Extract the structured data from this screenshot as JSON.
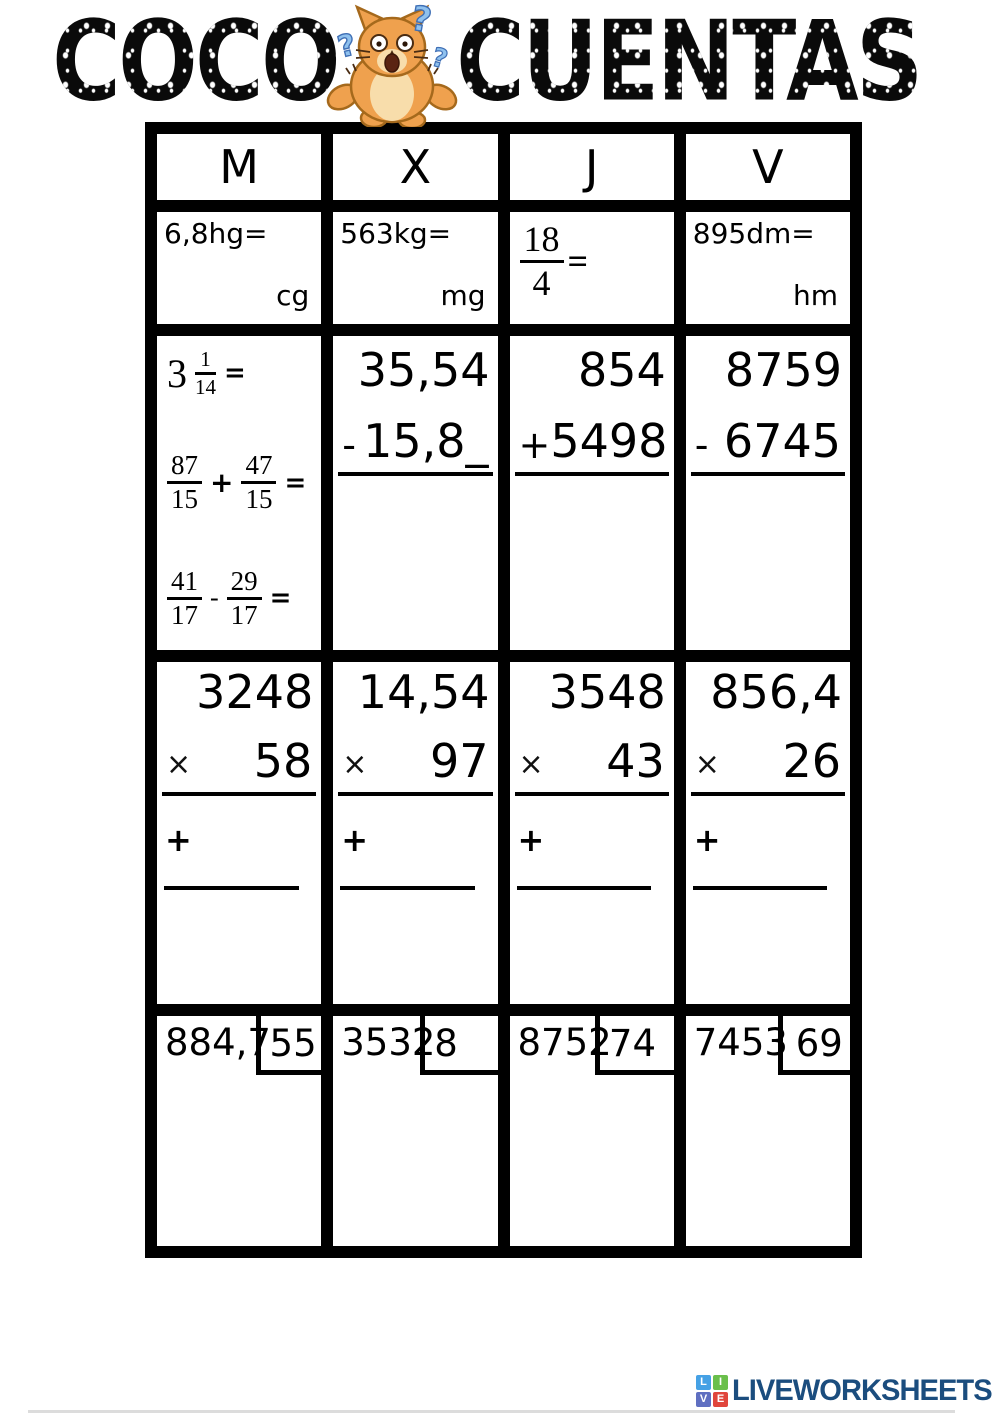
{
  "title": {
    "left": "COCO",
    "right": "CUENTAS"
  },
  "table": {
    "headers": [
      "M",
      "X",
      "J",
      "V"
    ],
    "conversions": [
      {
        "expr": "6,8hg=",
        "unit": "cg"
      },
      {
        "expr": "563kg=",
        "unit": "mg"
      },
      {
        "num": "18",
        "den": "4",
        "eq": "="
      },
      {
        "expr": "895dm=",
        "unit": "hm"
      }
    ],
    "fractions": {
      "item1": {
        "whole": "3",
        "num": "1",
        "den": "14",
        "eq": "="
      },
      "item2": {
        "a_num": "87",
        "a_den": "15",
        "op": "+",
        "b_num": "47",
        "b_den": "15",
        "eq": "="
      },
      "item3": {
        "a_num": "41",
        "a_den": "17",
        "op": "-",
        "b_num": "29",
        "b_den": "17",
        "eq": "="
      }
    },
    "vertical_ops": [
      {
        "top": "35,54",
        "op": "-",
        "bottom": "15,8_"
      },
      {
        "top": "854",
        "op": "+",
        "bottom": "5498"
      },
      {
        "top": "8759",
        "op": "-",
        "bottom": "6745"
      }
    ],
    "multiplications": [
      {
        "top": "3248",
        "op": "×",
        "bottom": "58",
        "plus": "+"
      },
      {
        "top": "14,54",
        "op": "×",
        "bottom": "97",
        "plus": "+"
      },
      {
        "top": "3548",
        "op": "×",
        "bottom": "43",
        "plus": "+"
      },
      {
        "top": "856,4",
        "op": "×",
        "bottom": "26",
        "plus": "+"
      }
    ],
    "divisions": [
      {
        "dividend": "884,7",
        "divisor": "55"
      },
      {
        "dividend": "3532",
        "divisor": "8"
      },
      {
        "dividend": "8752",
        "divisor": "74"
      },
      {
        "dividend": "7453",
        "divisor": "69"
      }
    ]
  },
  "footer": {
    "brand": "LIVEWORKSHEETS",
    "brand_color": "#1b4d7e",
    "tiles": [
      {
        "letter": "L",
        "color": "#45a1e5"
      },
      {
        "letter": "I",
        "color": "#6abf4b"
      },
      {
        "letter": "V",
        "color": "#5f6fc1"
      },
      {
        "letter": "E",
        "color": "#e0453c"
      }
    ]
  }
}
